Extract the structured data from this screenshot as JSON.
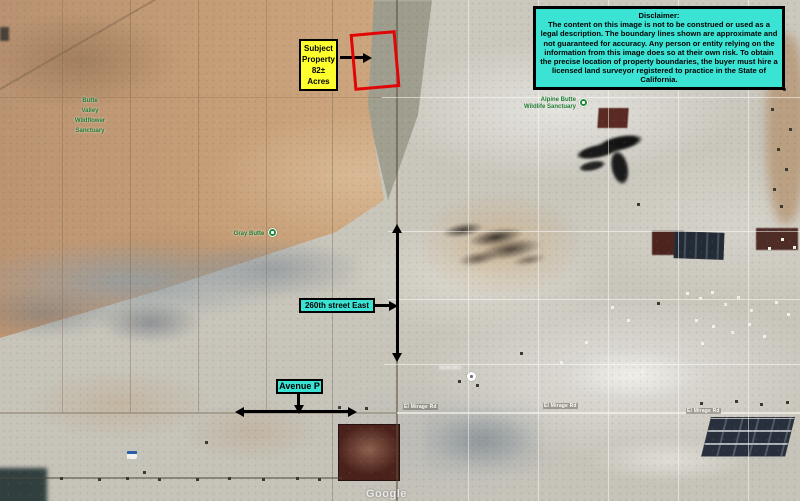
{
  "colors": {
    "cyan_label_bg": "#3be3d4",
    "yellow_label_bg": "#ffff2e",
    "boundary_red": "#e10505",
    "park_green": "#1c7a30"
  },
  "disclaimer": {
    "title": "Disclaimer:",
    "body": "The content on this image is not to be construed or used as a legal description. The boundary lines shown are approximate and not guaranteed for accuracy. Any person or entity relying on the information from this image does so at their own risk. To obtain the precise location of property boundaries, the buyer must hire a licensed land surveyor registered to practice in the State of California."
  },
  "subject_property": {
    "line1": "Subject",
    "line2": "Property",
    "line3": "82± Acres"
  },
  "street_labels": {
    "street_east": "260th street East",
    "avenue_p": "Avenue P"
  },
  "map_labels": {
    "park_nw": [
      "Butte",
      "Valley",
      "Wildflower",
      "Sanctuary"
    ],
    "park_center": "Gray Butte",
    "park_ne_line1": "Alpine Butte",
    "park_ne_line2": "Wildlife Sanctuary",
    "road_el_mirage_1": "El Mirage Rd",
    "road_el_mirage_2": "El Mirage Rd",
    "road_el_mirage_3": "El Mirage Rd",
    "watermark": "Google"
  }
}
